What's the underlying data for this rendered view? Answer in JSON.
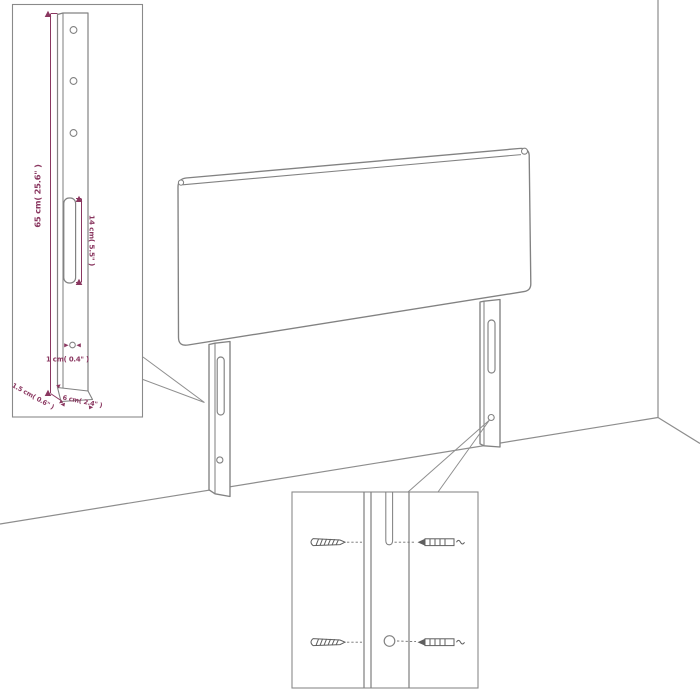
{
  "figure": {
    "type": "product-dimension-diagram",
    "subject": "headboard-with-legs-in-room-corner",
    "colors": {
      "outline": "#828282",
      "dimension_accent": "#8a3760",
      "background": "#ffffff"
    },
    "leg_inset": {
      "height_label": "65 cm( 25.6\" )",
      "slot_label": "14 cm( 5.5\" )",
      "hole_label": "1 cm( 0.4\" )",
      "thickness_label": "1.5 cm( 0.6\" )",
      "width_label": "6 cm( 2.4\" )"
    }
  }
}
